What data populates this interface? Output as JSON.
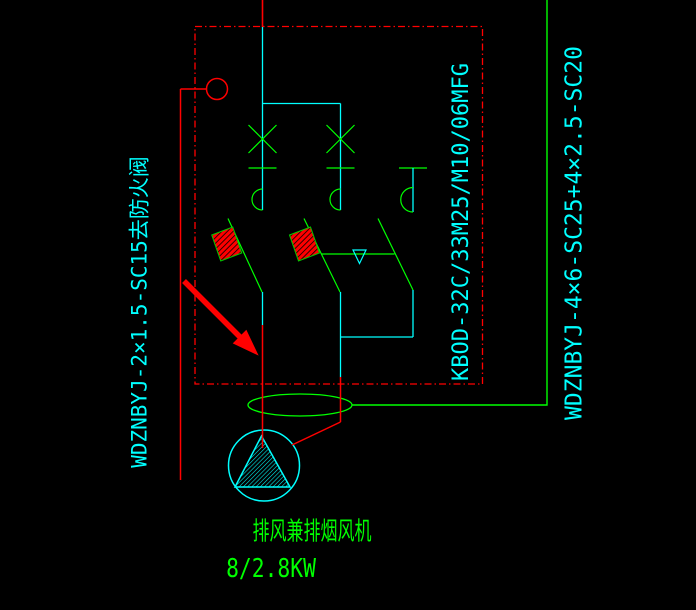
{
  "colors": {
    "background": "#000000",
    "wire_red": "#ff0000",
    "wire_green": "#00ff00",
    "wire_cyan": "#00ffff"
  },
  "labels": {
    "left_cable": "WDZNBYJ-2×1.5-SC15去防火阀",
    "breaker_model": "KBOD-32C/33M25/M10/06MFG",
    "right_cable": "WDZNBYJ-4×6-SC25+4×2.5-SC20",
    "fan_name": "排风兼排烟风机",
    "fan_power": "8/2.8KW"
  }
}
